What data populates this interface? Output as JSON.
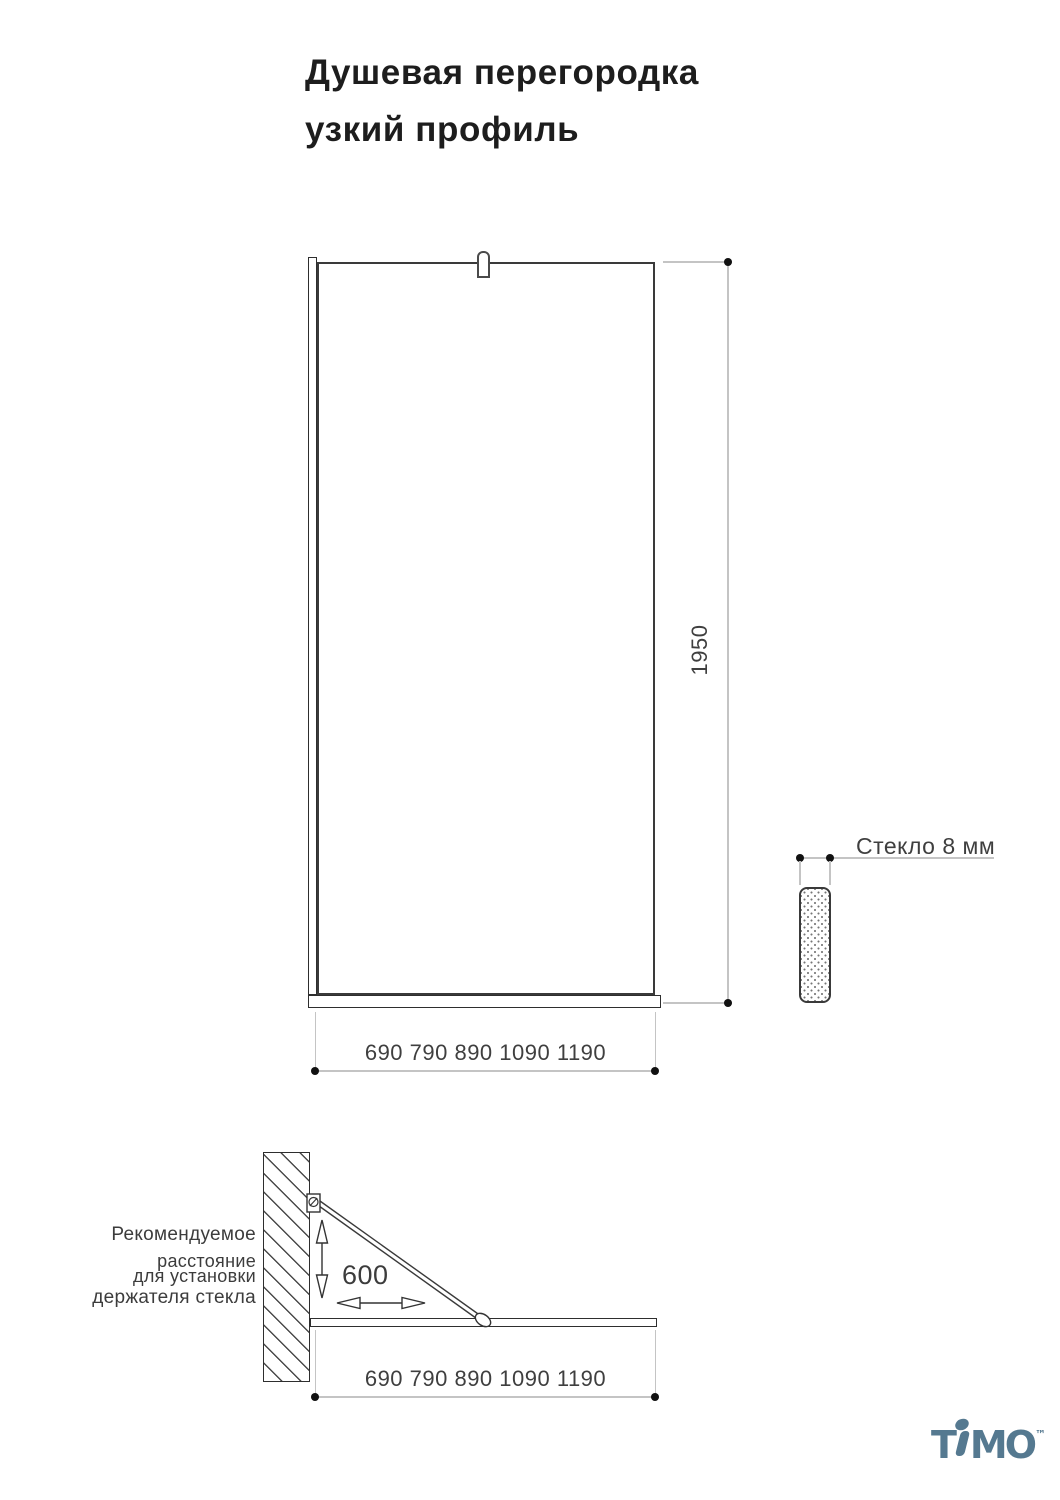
{
  "title": {
    "line1": "Душевая перегородка",
    "line2": "узкий профиль"
  },
  "front_view": {
    "height_label": "1950",
    "width_label": "690 790 890 1090 1190"
  },
  "glass_section": {
    "label": "Стекло 8 мм"
  },
  "side_view": {
    "note_line1": "Рекомендуемое",
    "note_line2": "расстояние",
    "note_line3": "для установки",
    "note_line4": "держателя стекла",
    "holder_distance_label": "600",
    "width_label": "690 790 890 1090 1190"
  },
  "logo": {
    "brand": "TIMO",
    "part_t": "T",
    "part_mo": "MO",
    "trademark": "™"
  },
  "colors": {
    "drawing_line": "#3a3a3a",
    "dimension_line": "#c4c4c4",
    "dimension_dot": "#111111",
    "dimension_text": "#3f3f3f",
    "logo": "#557990"
  }
}
